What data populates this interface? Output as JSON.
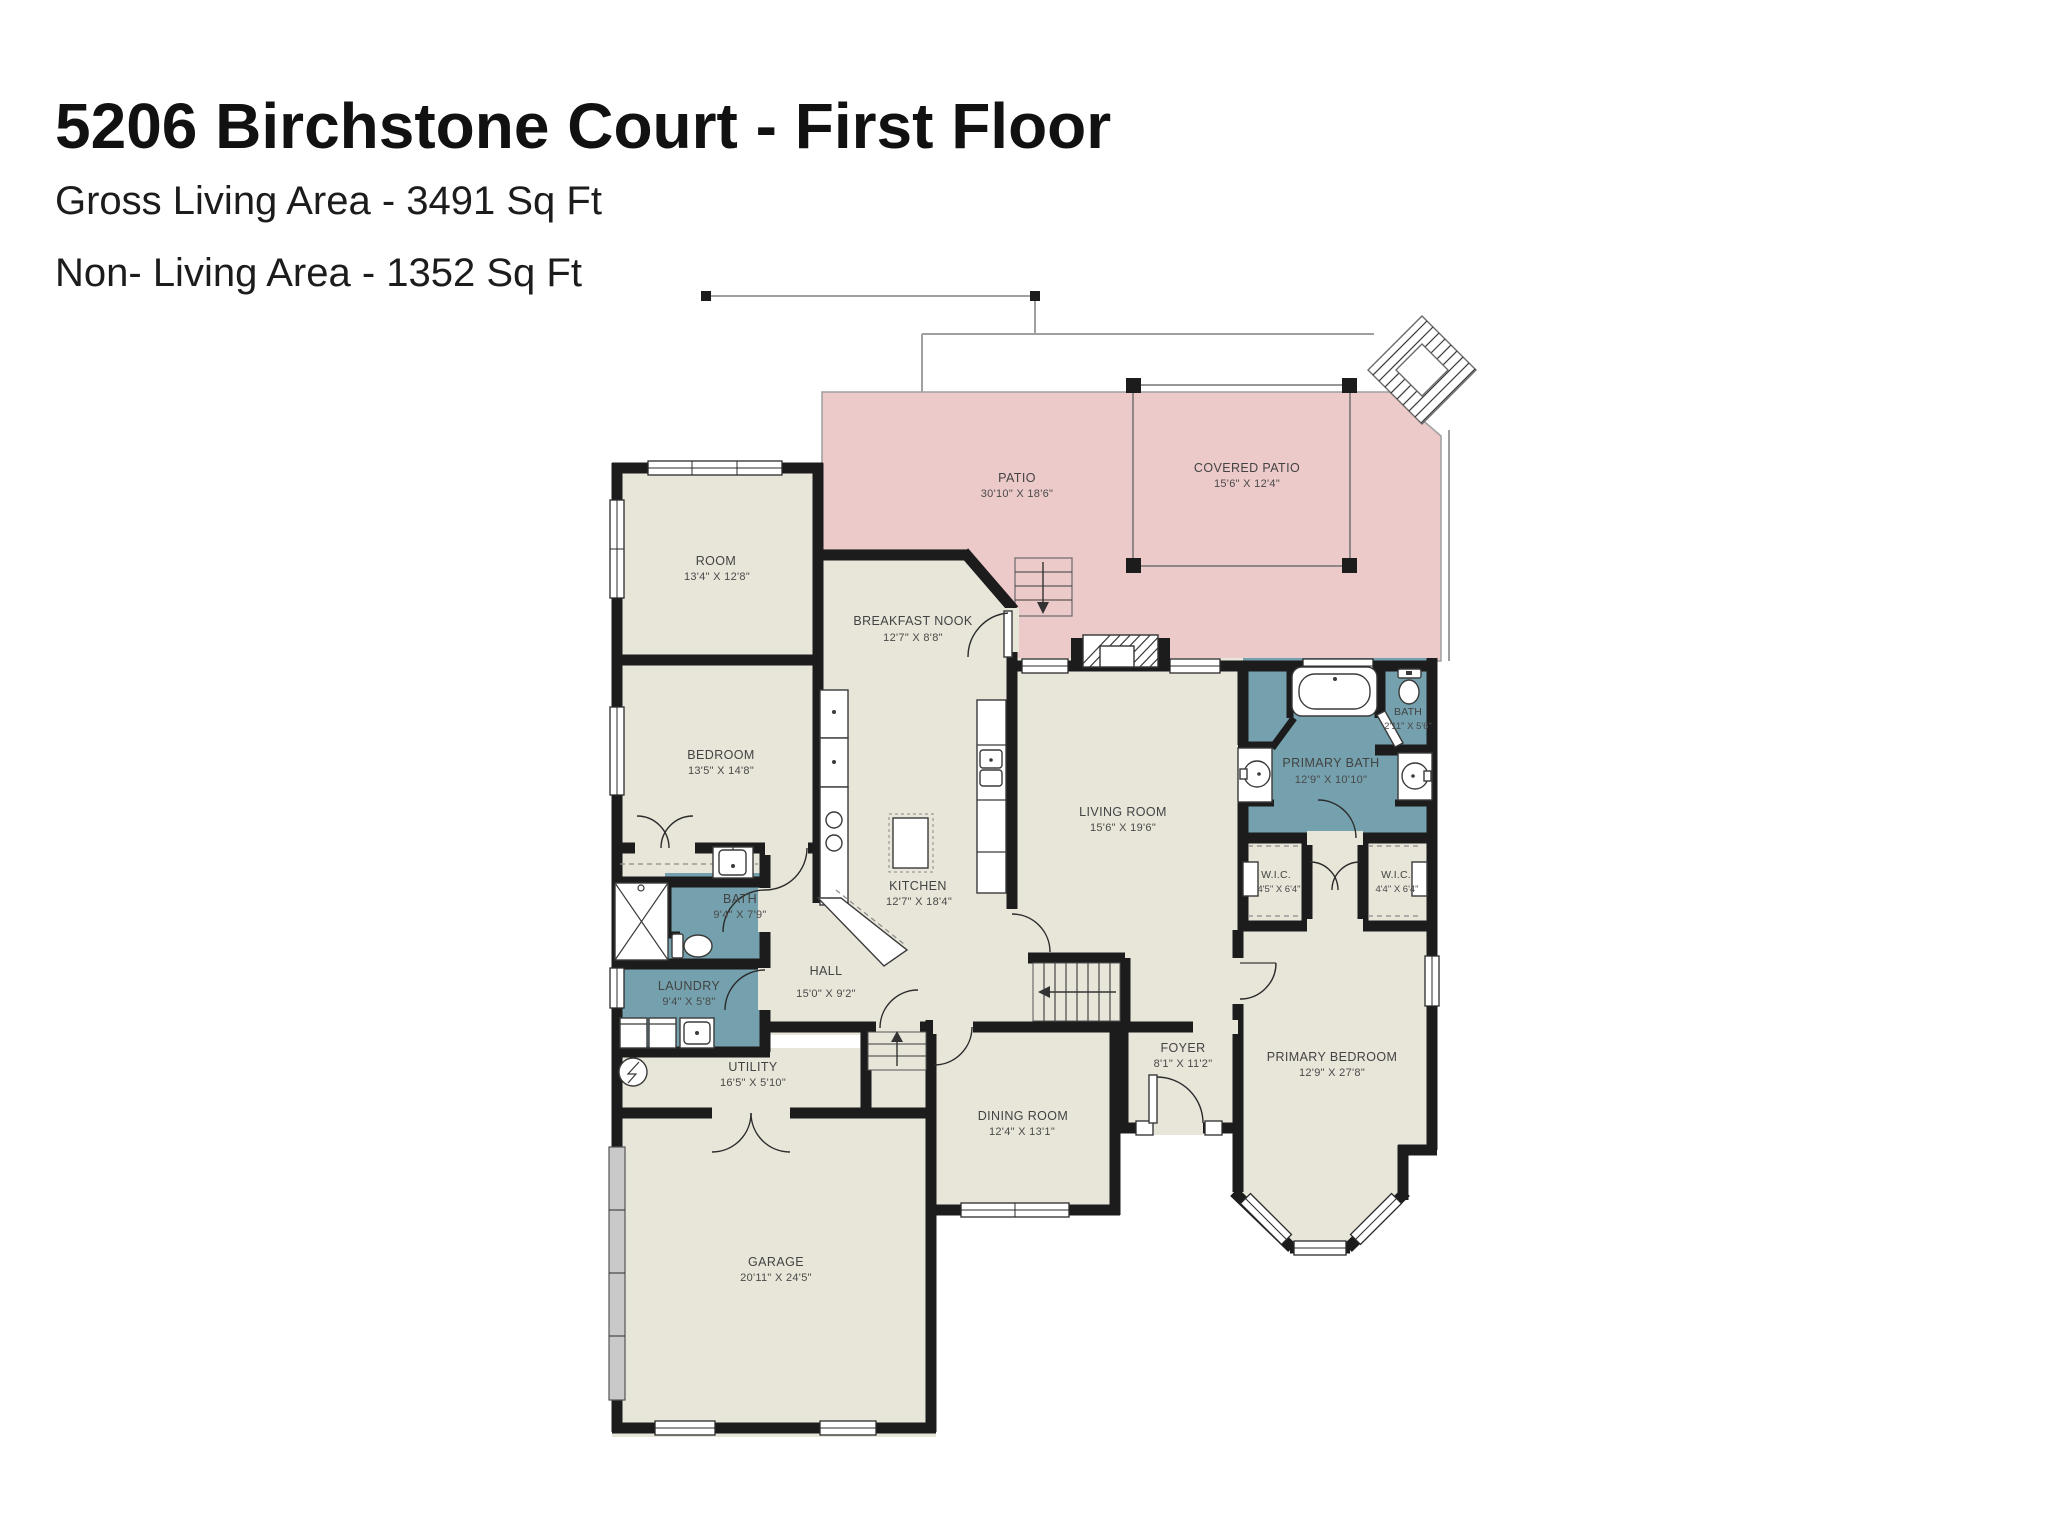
{
  "header": {
    "title": "5206 Birchstone Court - First Floor",
    "gross_living": "Gross Living Area - 3491 Sq Ft",
    "non_living": "Non- Living Area - 1352 Sq Ft"
  },
  "colors": {
    "background": "#ffffff",
    "wall": "#1c1c1c",
    "floor": "#e8e5d9",
    "patio": "#eccac9",
    "wet_room": "#74a1ad",
    "label_text": "#434343"
  },
  "rooms": {
    "patio": {
      "name": "PATIO",
      "dims": "30'10\" X 18'6\""
    },
    "covered_patio": {
      "name": "COVERED PATIO",
      "dims": "15'6\" X 12'4\""
    },
    "room": {
      "name": "ROOM",
      "dims": "13'4\" X 12'8\""
    },
    "breakfast_nook": {
      "name": "BREAKFAST NOOK",
      "dims": "12'7\" X 8'8\""
    },
    "bedroom": {
      "name": "BEDROOM",
      "dims": "13'5\" X 14'8\""
    },
    "bath": {
      "name": "BATH",
      "dims": "9'4\" X 7'9\""
    },
    "laundry": {
      "name": "LAUNDRY",
      "dims": "9'4\" X 5'8\""
    },
    "kitchen": {
      "name": "KITCHEN",
      "dims": "12'7\" X 18'4\""
    },
    "hall": {
      "name": "HALL",
      "dims": "15'0\" X 9'2\""
    },
    "utility": {
      "name": "UTILITY",
      "dims": "16'5\" X 5'10\""
    },
    "living_room": {
      "name": "LIVING ROOM",
      "dims": "15'6\" X 19'6\""
    },
    "primary_bath": {
      "name": "PRIMARY BATH",
      "dims": "12'9\" X 10'10\""
    },
    "toilet_room": {
      "name": "BATH",
      "dims": "2'11\" X 5'6\""
    },
    "wic_left": {
      "name": "W.I.C.",
      "dims": "4'5\" X 6'4\""
    },
    "wic_right": {
      "name": "W.I.C.",
      "dims": "4'4\" X 6'4\""
    },
    "foyer": {
      "name": "FOYER",
      "dims": "8'1\" X 11'2\""
    },
    "dining_room": {
      "name": "DINING ROOM",
      "dims": "12'4\" X 13'1\""
    },
    "primary_bedroom": {
      "name": "PRIMARY BEDROOM",
      "dims": "12'9\" X 27'8\""
    },
    "garage": {
      "name": "GARAGE",
      "dims": "20'11\" X 24'5\""
    }
  }
}
